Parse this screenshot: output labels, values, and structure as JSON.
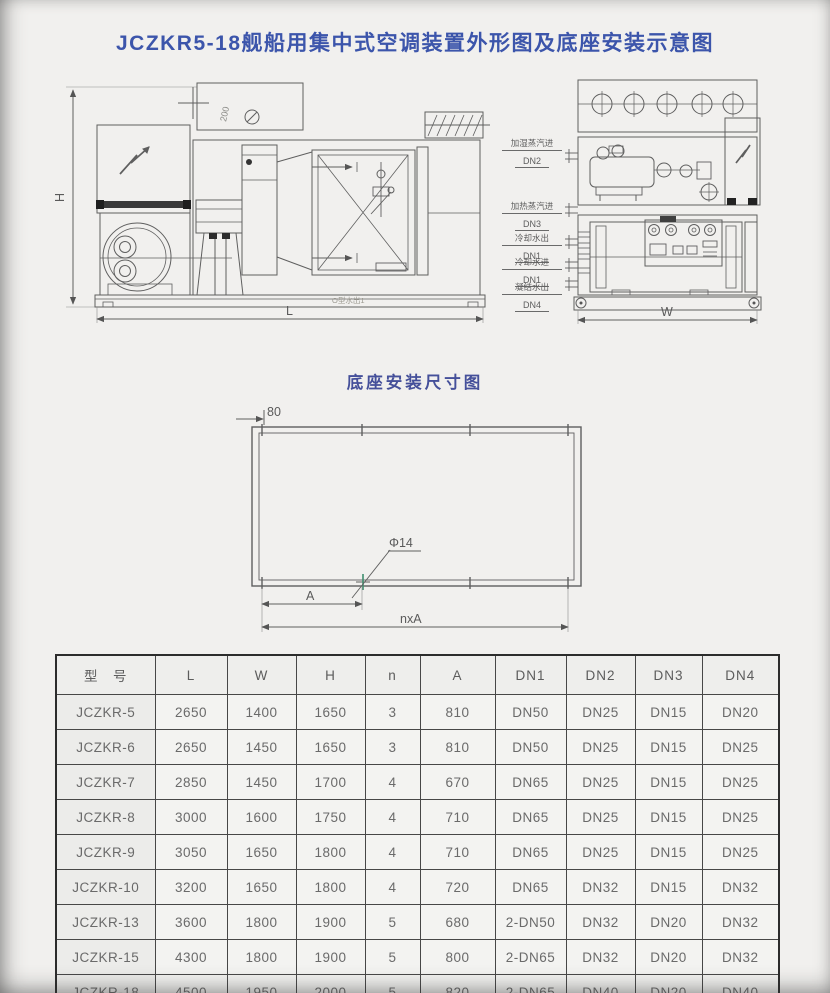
{
  "page": {
    "title": "JCZKR5-18舰船用集中式空调装置外形图及底座安装示意图"
  },
  "drawing": {
    "left_view": {
      "dim_h": "H",
      "dim_l": "L",
      "plenum_note": "200",
      "base_note": "O型水出1"
    },
    "right_view": {
      "dim_w": "W",
      "ports": [
        {
          "name": "加湿蒸汽进",
          "dn": "DN2"
        },
        {
          "name": "加热蒸汽进",
          "dn": "DN3"
        },
        {
          "name": "冷却水出",
          "dn": "DN1"
        },
        {
          "name": "冷却水进",
          "dn": "DN1"
        },
        {
          "name": "凝结水出",
          "dn": "DN4"
        }
      ]
    }
  },
  "base_diagram": {
    "title": "底座安装尺寸图",
    "offset": "80",
    "hole_dia": "Φ14",
    "dim_a": "A",
    "dim_na": "nxA"
  },
  "table": {
    "headers": [
      "型　号",
      "L",
      "W",
      "H",
      "n",
      "A",
      "DN1",
      "DN2",
      "DN3",
      "DN4"
    ],
    "rows": [
      [
        "JCZKR-5",
        "2650",
        "1400",
        "1650",
        "3",
        "810",
        "DN50",
        "DN25",
        "DN15",
        "DN20"
      ],
      [
        "JCZKR-6",
        "2650",
        "1450",
        "1650",
        "3",
        "810",
        "DN50",
        "DN25",
        "DN15",
        "DN25"
      ],
      [
        "JCZKR-7",
        "2850",
        "1450",
        "1700",
        "4",
        "670",
        "DN65",
        "DN25",
        "DN15",
        "DN25"
      ],
      [
        "JCZKR-8",
        "3000",
        "1600",
        "1750",
        "4",
        "710",
        "DN65",
        "DN25",
        "DN15",
        "DN25"
      ],
      [
        "JCZKR-9",
        "3050",
        "1650",
        "1800",
        "4",
        "710",
        "DN65",
        "DN25",
        "DN15",
        "DN25"
      ],
      [
        "JCZKR-10",
        "3200",
        "1650",
        "1800",
        "4",
        "720",
        "DN65",
        "DN32",
        "DN15",
        "DN32"
      ],
      [
        "JCZKR-13",
        "3600",
        "1800",
        "1900",
        "5",
        "680",
        "2-DN50",
        "DN32",
        "DN20",
        "DN32"
      ],
      [
        "JCZKR-15",
        "4300",
        "1800",
        "1900",
        "5",
        "800",
        "2-DN65",
        "DN32",
        "DN20",
        "DN32"
      ],
      [
        "JCZKR-18",
        "4500",
        "1950",
        "2000",
        "5",
        "820",
        "2-DN65",
        "DN40",
        "DN20",
        "DN40"
      ]
    ]
  }
}
